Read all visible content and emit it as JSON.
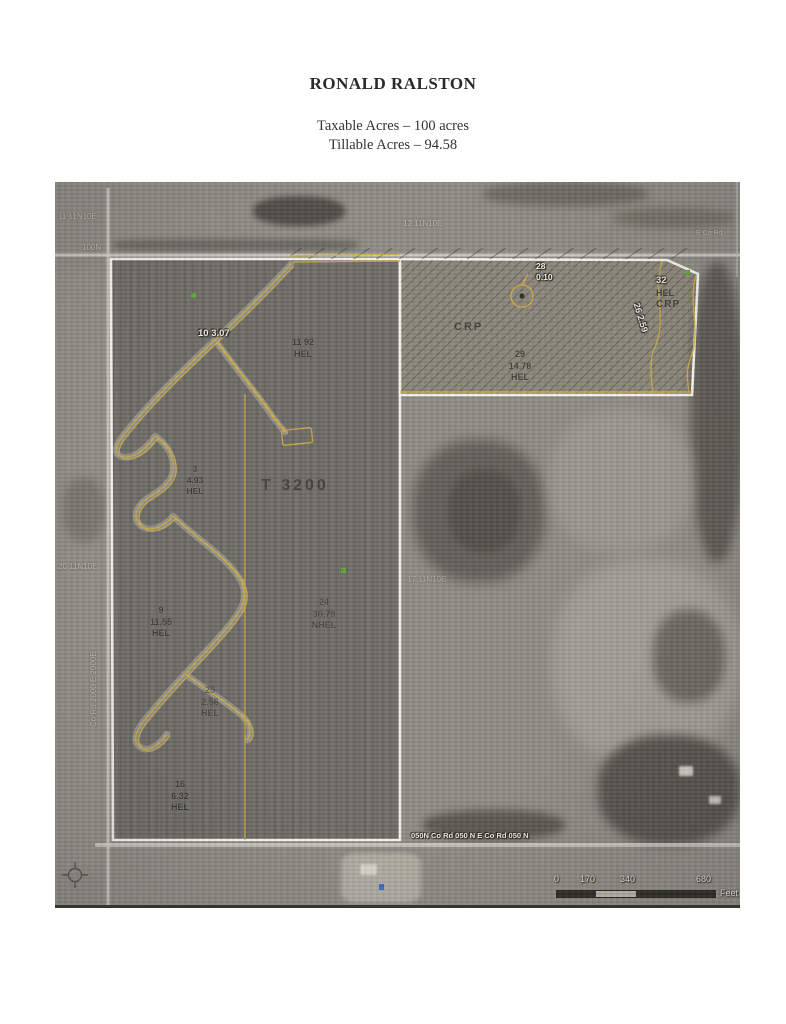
{
  "document": {
    "owner_name": "RONALD RALSTON",
    "taxable_acres_line": "Taxable Acres – 100 acres",
    "tillable_acres_line": "Tillable Acres – 94.58"
  },
  "map": {
    "section_labels": [
      {
        "text": "11 11N10E"
      },
      {
        "text": "12 11N10E"
      },
      {
        "text": "20 11N10E"
      },
      {
        "text": "17 11N10E"
      }
    ],
    "road_labels": {
      "top": "100N",
      "top_right": "E Co Rd",
      "left_vertical": "Co Rd 2000 E    2000E",
      "bottom": "050N  Co Rd 050 N  E Co Rd 050 N"
    },
    "field_labels": {
      "f10": {
        "text": "10 3.07"
      },
      "f11": {
        "lines": [
          "11 92",
          "HEL"
        ]
      },
      "f3": {
        "lines": [
          "3",
          "4.93",
          "HEL"
        ]
      },
      "t3200": {
        "text": "T 3200"
      },
      "f9": {
        "lines": [
          "9",
          "11.55",
          "HEL"
        ]
      },
      "f24": {
        "lines": [
          "24",
          "30.79",
          "NHEL"
        ]
      },
      "f25": {
        "lines": [
          "25",
          "2.56",
          "HEL"
        ]
      },
      "f16": {
        "lines": [
          "16",
          "6.32",
          "HEL"
        ]
      },
      "crp": {
        "text": "CRP"
      },
      "f28": {
        "lines": [
          "28",
          "0.10"
        ]
      },
      "f29": {
        "lines": [
          "29",
          "14.78",
          "HEL"
        ]
      },
      "f26": {
        "text": "26 2.59"
      },
      "f32": {
        "lines": [
          "32",
          "HEL",
          "CRP"
        ]
      }
    },
    "scale_bar": {
      "ticks": [
        "0",
        "170",
        "340",
        "680"
      ],
      "unit": "Feet"
    },
    "colors": {
      "parcel_boundary": "#f6f4ee",
      "field_line": "#cfae45",
      "marker_green": "#63a33c",
      "marker_blue": "#3f6fc0"
    }
  }
}
